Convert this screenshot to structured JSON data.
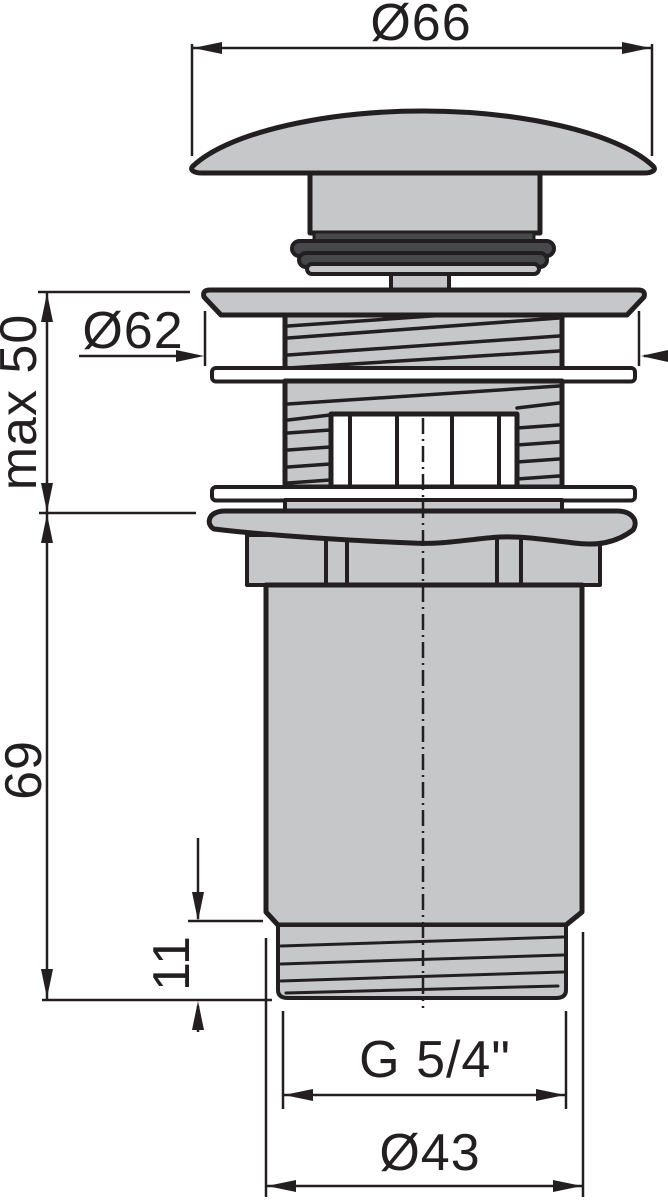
{
  "diagram": {
    "labels": {
      "cap_diameter": "Ø66",
      "flange_diameter": "Ø62",
      "max_clamp_thickness": "max 50",
      "body_length": "69",
      "outlet_thread_length": "11",
      "outlet_thread_size": "G 5/4\"",
      "outlet_diameter": "Ø43"
    },
    "colors": {
      "line": "#231f20",
      "metal_fill": "#c6c7c9",
      "seal_fill": "#47484a",
      "background": "#ffffff"
    }
  }
}
